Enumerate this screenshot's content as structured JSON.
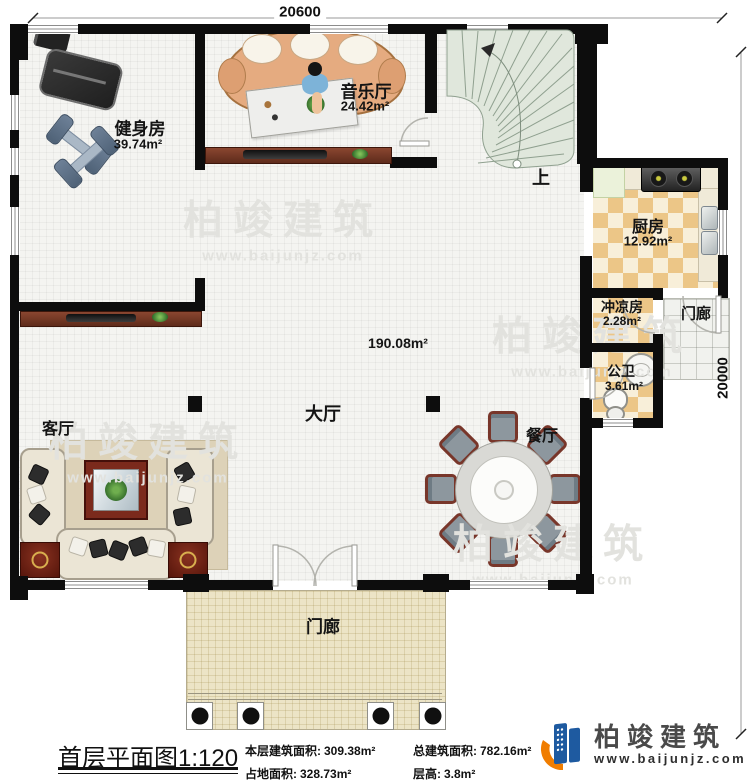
{
  "dimensions": {
    "width_label": "20600",
    "height_label": "20000"
  },
  "rooms": {
    "gym": {
      "name": "健身房",
      "area": "39.74m²"
    },
    "music_hall": {
      "name": "音乐厅",
      "area": "24.42m²"
    },
    "kitchen": {
      "name": "厨房",
      "area": "12.92m²"
    },
    "shower_room": {
      "name": "冲凉房",
      "area": "2.28m²"
    },
    "public_bathroom": {
      "name": "公卫",
      "area": "3.61m²"
    },
    "main_hall": {
      "name": "大厅",
      "area": "190.08m²"
    },
    "living_room": {
      "name": "客厅"
    },
    "dining_room": {
      "name": "餐厅"
    },
    "porch_side": {
      "name": "门廊"
    },
    "porch_front": {
      "name": "门廊"
    },
    "stairs": {
      "up_label": "上"
    }
  },
  "titleblock": {
    "plan_title": "首层平面图",
    "plan_scale": "1:120",
    "stats": [
      {
        "label": "本层建筑面积:",
        "value": "309.38m²"
      },
      {
        "label": "总建筑面积:",
        "value": "782.16m²"
      },
      {
        "label": "占地面积:",
        "value": "328.73m²"
      },
      {
        "label": "层高:",
        "value": "3.8m²"
      }
    ]
  },
  "brand": {
    "name": "柏竣建筑",
    "website": "www.baijunjz.com"
  },
  "watermark": {
    "name": "柏竣建筑",
    "website": "www.baijunjz.com"
  },
  "colors": {
    "wall": "#0d0d0d",
    "floor": "#f4f4f1",
    "checker": "#ecc687",
    "wood": "#6b3426",
    "stairs": "#e0e7dc",
    "porch": "#ece4c6",
    "brand_blue": "#1e5aa0",
    "brand_orange": "#f07d00",
    "watermark": "#e2e2de"
  }
}
